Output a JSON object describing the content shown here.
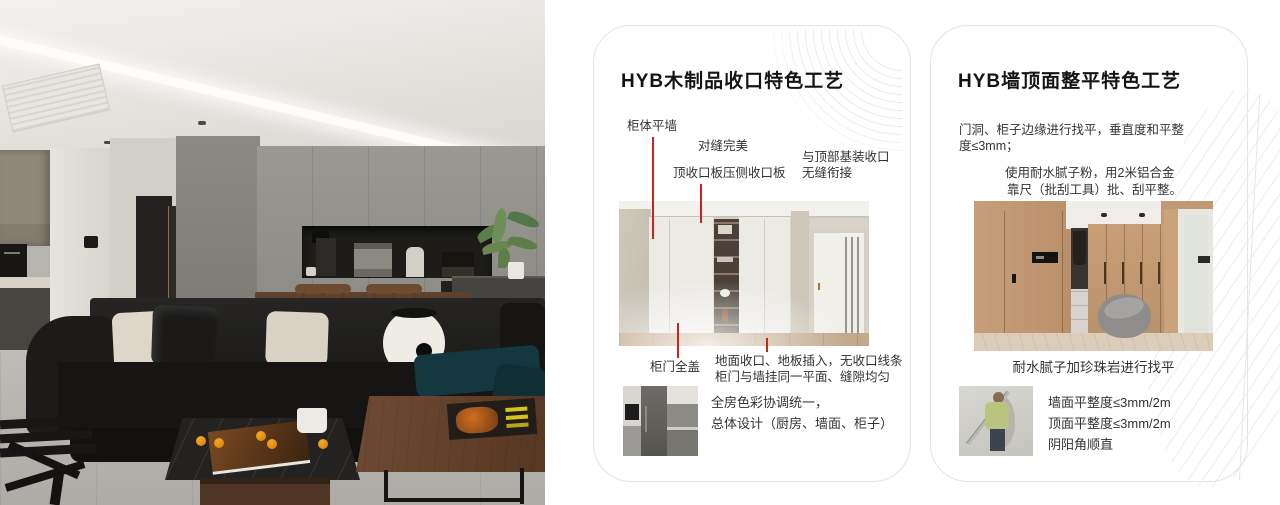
{
  "colors": {
    "accent_red": "#c9251d",
    "card_border": "#e4e4e4",
    "title_text": "#141414",
    "body_text": "#333333",
    "pattern_line": "#ececec"
  },
  "card1": {
    "title": "HYB木制品收口特色工艺",
    "labels": {
      "cabinet_flush_wall": "柜体平墙",
      "perfect_seam": "对缝完美",
      "top_closing_panel": "顶收口板压侧收口板",
      "ceiling_joint_line1": "与顶部基装收口",
      "ceiling_joint_line2": "无缝衔接",
      "full_cover_door": "柜门全盖"
    },
    "notes_line1": "地面收口、地板插入，无收口线条",
    "notes_line2": "柜门与墙挂同一平面、缝隙均匀",
    "footer_line1": "全房色彩协调统一，",
    "footer_line2": "总体设计（厨房、墙面、柜子）"
  },
  "card2": {
    "title": "HYB墙顶面整平特色工艺",
    "para1_line1": "门洞、柜子边缘进行找平，垂直度和平整",
    "para1_line2": "度≤3mm；",
    "para2_line1": "使用耐水腻子粉，用2米铝合金",
    "para2_line2": "靠尺（批刮工具）批、刮平整。",
    "caption": "耐水腻子加珍珠岩进行找平",
    "specs": [
      "墙面平整度≤3mm/2m",
      "顶面平整度≤3mm/2m",
      "阴阳角顺直"
    ]
  }
}
